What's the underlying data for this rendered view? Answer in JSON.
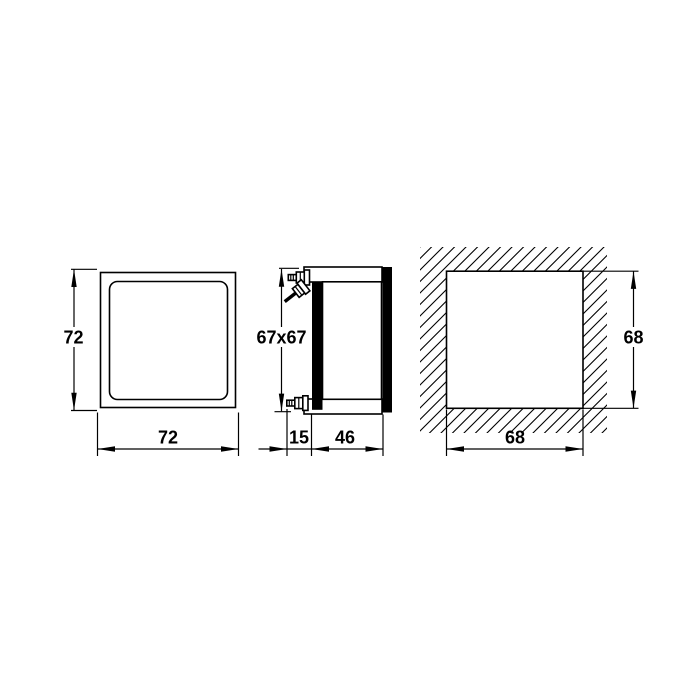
{
  "drawing": {
    "background": "#ffffff",
    "line_color": "#000000",
    "dims": {
      "front_width": "72",
      "front_height": "72",
      "side_section": "67x67",
      "depth_front": "15",
      "depth_body": "46",
      "cutout_width": "68",
      "cutout_height": "68"
    }
  }
}
